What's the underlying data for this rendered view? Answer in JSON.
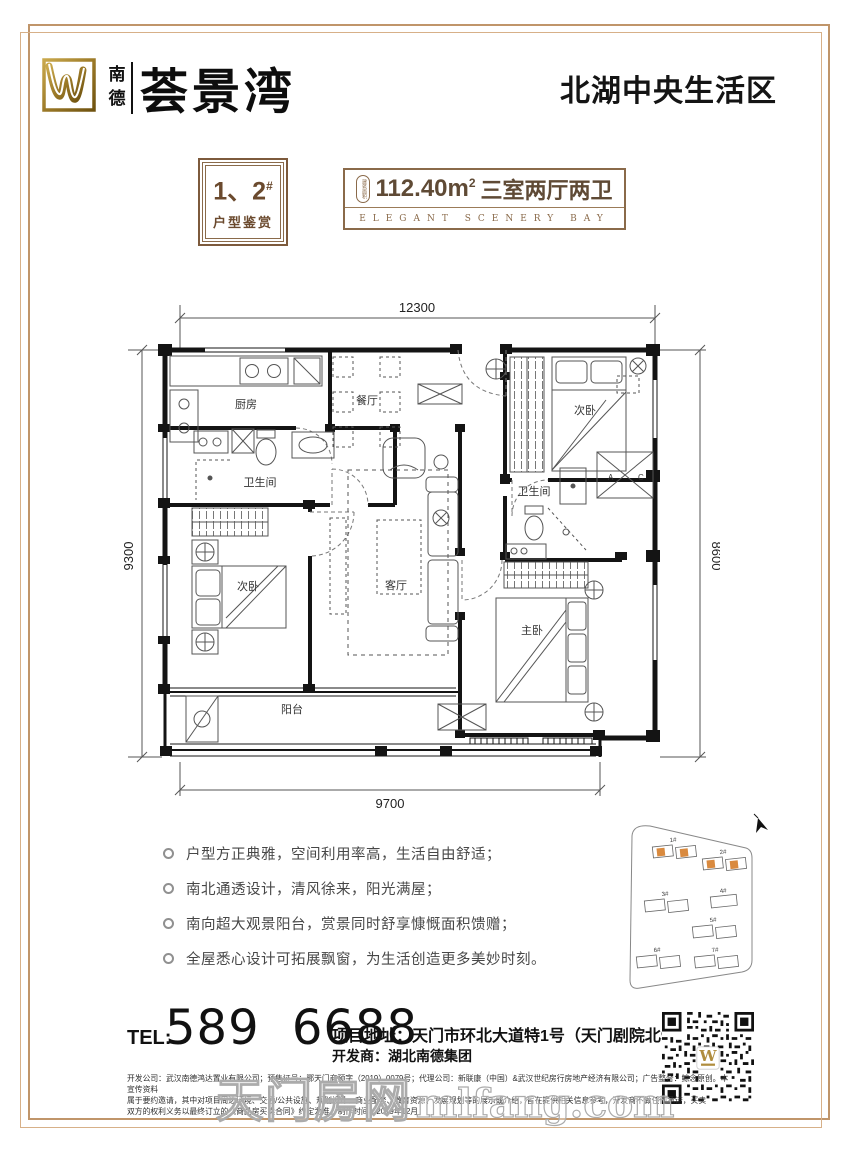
{
  "header": {
    "brand_char1": "南",
    "brand_char2": "德",
    "brand_name": "荟景湾",
    "region_title": "北湖中央生活区"
  },
  "badge": {
    "number": "1、2",
    "hash": "#",
    "caption": "户型鉴赏"
  },
  "area_box": {
    "pill_label": "建筑面积",
    "value": "112.40m",
    "sup": "2",
    "layout": "三室两厅两卫",
    "subtitle_en": "ELEGANT SCENERY BAY"
  },
  "floor_plan": {
    "dim_top": "12300",
    "dim_left": "9300",
    "dim_right": "8600",
    "dim_bottom": "9700",
    "rooms": {
      "kitchen": "厨房",
      "dining": "餐厅",
      "bedroom_top": "次卧",
      "bath_left": "卫生间",
      "bedroom_left": "次卧",
      "living": "客厅",
      "bath_right": "卫生间",
      "master": "主卧",
      "balcony": "阳台"
    },
    "stair_a": "A",
    "stair_c": "C"
  },
  "features": {
    "items": [
      "户型方正典雅，空间利用率高，生活自由舒适；",
      "南北通透设计，清风徐来，阳光满屋；",
      "南向超大观景阳台，赏景同时舒享慷慨面积馈赠；",
      "全屋悉心设计可拓展飘窗，为生活创造更多美妙时刻。"
    ]
  },
  "site_plan": {
    "buildings": [
      "1#",
      "2#",
      "3#",
      "4#",
      "5#",
      "6#",
      "7#"
    ]
  },
  "contact": {
    "tel_label": "TEL:",
    "tel_number": "589 6688",
    "address_label": "项目地址：",
    "address": "天门市环北大道特1号（天门剧院北900米）",
    "developer_label": "开发商：",
    "developer": "湖北南德集团"
  },
  "legal": {
    "lines": [
      "开发公司：武汉南德鸿达置业有限公司；预售证号：鄂天门商预字（2019）0079号；代理公司：新联康（中国）&武汉世纪房行房地产经济有限公司；广告整合：鲸念原创。本宣传资料",
      "属于要约邀请，其中对项目周边环境、交通/公共设施、规划设计、商业配套、教育资源、发展规划等的展示或介绍，旨在提供相关信息参考，开发商不做任何承诺，买卖",
      "双方的权利义务以最终订立的《商品房买卖合同》约定为准。制作时间：2019年12月"
    ]
  },
  "watermark": {
    "cn": "天门房网",
    "en": "mlfang.com"
  }
}
